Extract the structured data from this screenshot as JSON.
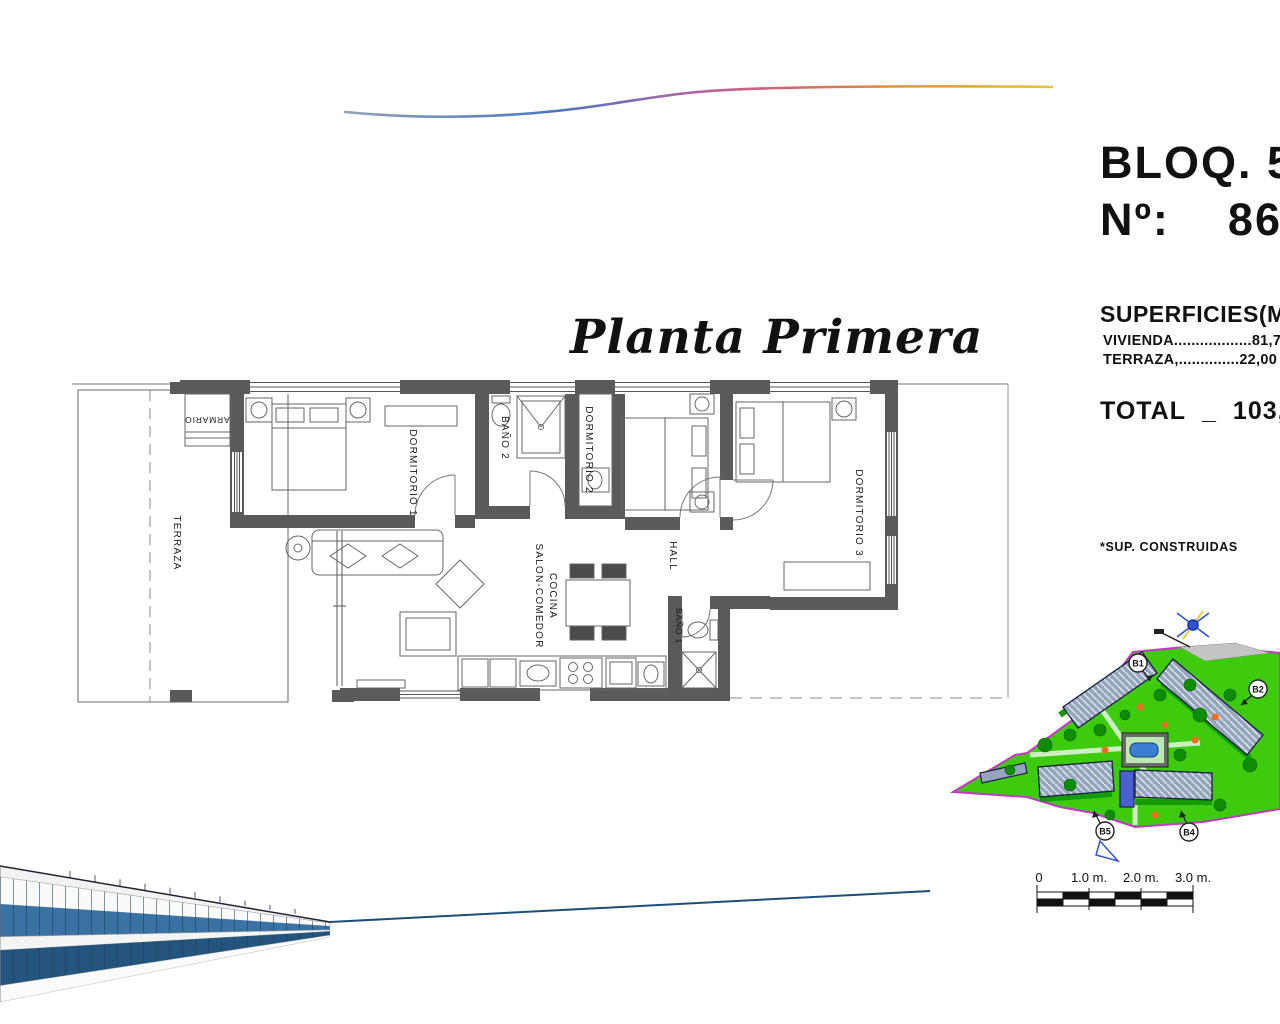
{
  "header": {
    "bloq_label": "BLOQ. 5",
    "num_label": "Nº:",
    "num_value": "86"
  },
  "plan_title": "Planta Primera",
  "surfaces": {
    "heading": "SUPERFICIES(M2)",
    "vivienda_label": "VIVIENDA",
    "vivienda_dots": "..................",
    "vivienda_value": "81,75*",
    "terraza_label": "TERRAZA,",
    "terraza_dots": "..............",
    "terraza_value": "22,00",
    "total_label": "TOTAL",
    "total_sep": "_",
    "total_value": "103,75",
    "footnote": "*SUP. CONSTRUIDAS"
  },
  "floorplan": {
    "rooms": {
      "terraza": "TERRAZA",
      "armario": "ARMARIO",
      "dormitorio1": "DORMITORIO 1",
      "bano2": "BAÑO 2",
      "dormitorio2": "DORMITORIO 2",
      "dormitorio3": "DORMITORIO 3",
      "hall": "HALL",
      "salon_line1": "SALON-COMEDOR",
      "salon_line2": "COCINA",
      "bano1": "BAÑO 1"
    }
  },
  "siteplan": {
    "labels": {
      "b1": "B1",
      "b2": "B2",
      "b4": "B4",
      "b5": "B5"
    }
  },
  "scalebar": {
    "tick0": "0",
    "tick1": "1.0 m.",
    "tick2": "2.0 m.",
    "tick3": "3.0 m."
  },
  "colors": {
    "wall_gray": "#5a5a5a",
    "site_green": "#3ecb0e",
    "tree_green": "#0f8c04",
    "boundary_purple": "#c23ac2",
    "pool_blue": "#3a7fd4",
    "render_blue": "#1d4f79",
    "wave_blue": "#4a76c4",
    "wave_pink": "#d4636e",
    "wave_orange": "#ecc240"
  }
}
